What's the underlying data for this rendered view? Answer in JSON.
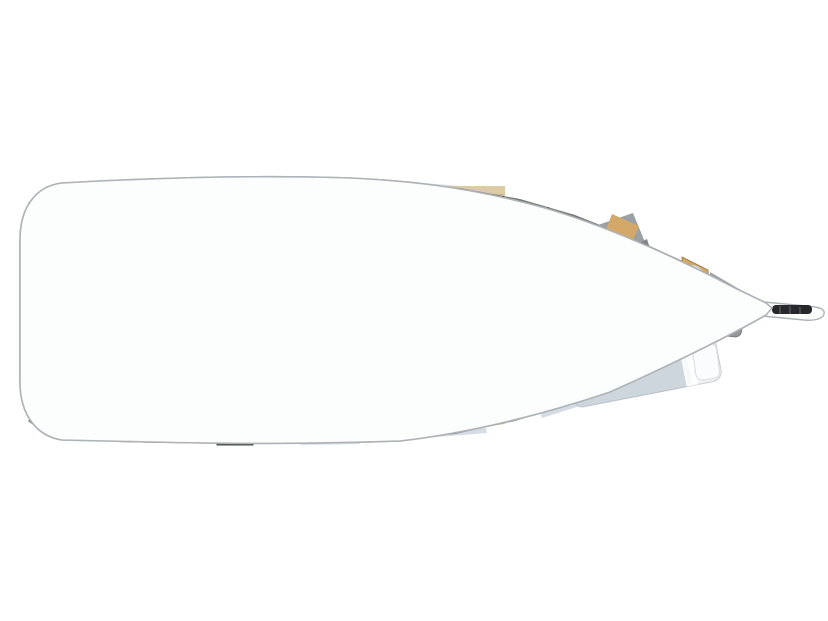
{
  "meta": {
    "title": "Sailboat interior layout plan (top view, bow to the right)"
  },
  "canvas": {
    "width": 828,
    "height": 621,
    "background": "#ffffff"
  },
  "palette": {
    "hull_fill": "#fcfdfd",
    "hull_stroke": "#aeb3b6",
    "hull_inner": "#e4e6e8",
    "deck": "#74787b",
    "deck_dark": "#626669",
    "window": "#ccd7e2",
    "floor": "#ddcba6",
    "floor_line": "#ccb88f",
    "wood": "#c18a4b",
    "wood_light": "#d4a869",
    "wood_dark": "#9c6f33",
    "mattress": "#d3d8dd",
    "mattress_fwd": "#cdd5dd",
    "bedframe": "#f1f3f4",
    "pillow": "#fbfcfd",
    "pillow_line": "#d7dbde",
    "blue": "#5a74b4",
    "blue_light": "#7089c5",
    "blue_dark": "#47619f",
    "white_furn": "#fbfcfc",
    "furn_line": "#b7bcc0",
    "steel": "#c6ccd0",
    "steel_dark": "#8b9297",
    "locker": "#5a5c57",
    "locker_line": "#43453f",
    "frame_gray": "#6c7073",
    "shower": "#9aa0a4",
    "shower_dark": "#82878b",
    "stone": "#b2b8bc",
    "bag": "#94989b",
    "bag_dark": "#7b7f82",
    "black": "#26282b",
    "speaker_ring": "#b56f6e",
    "speaker_core": "#aeb3b7",
    "arc_line": "#6e7276",
    "wall": "#4e5254",
    "stripe1": "#eef0f3",
    "stripe2": "#8e9ac4",
    "stripe3": "#c7ccd7",
    "stripe4": "#5f6da1",
    "stripe5": "#f4f5f6",
    "stripe6": "#7c87ab"
  },
  "areas": {
    "hull": "hull and side decks",
    "transom": "transom / swim platform",
    "aft_cabin_port": "aft double cabin (port)",
    "aft_cabin_starboard": "aft double cabin (starboard)",
    "engine_room": "engine compartment",
    "companionway": "companionway steps",
    "nav_station": "nav station seat and chart table",
    "galley": "galley with stove, sinks and fridge",
    "saloon": "saloon",
    "dinette": "starboard settee",
    "sofa": "saloon sofa with table",
    "aft_head": "aft head (toilet & shower)",
    "forward_head": "forward head (toilet & shower)",
    "forward_cabin": "forward owner cabin",
    "anchor_locker": "bow sail locker",
    "bowsprit": "bowsprit and anchor roller"
  }
}
